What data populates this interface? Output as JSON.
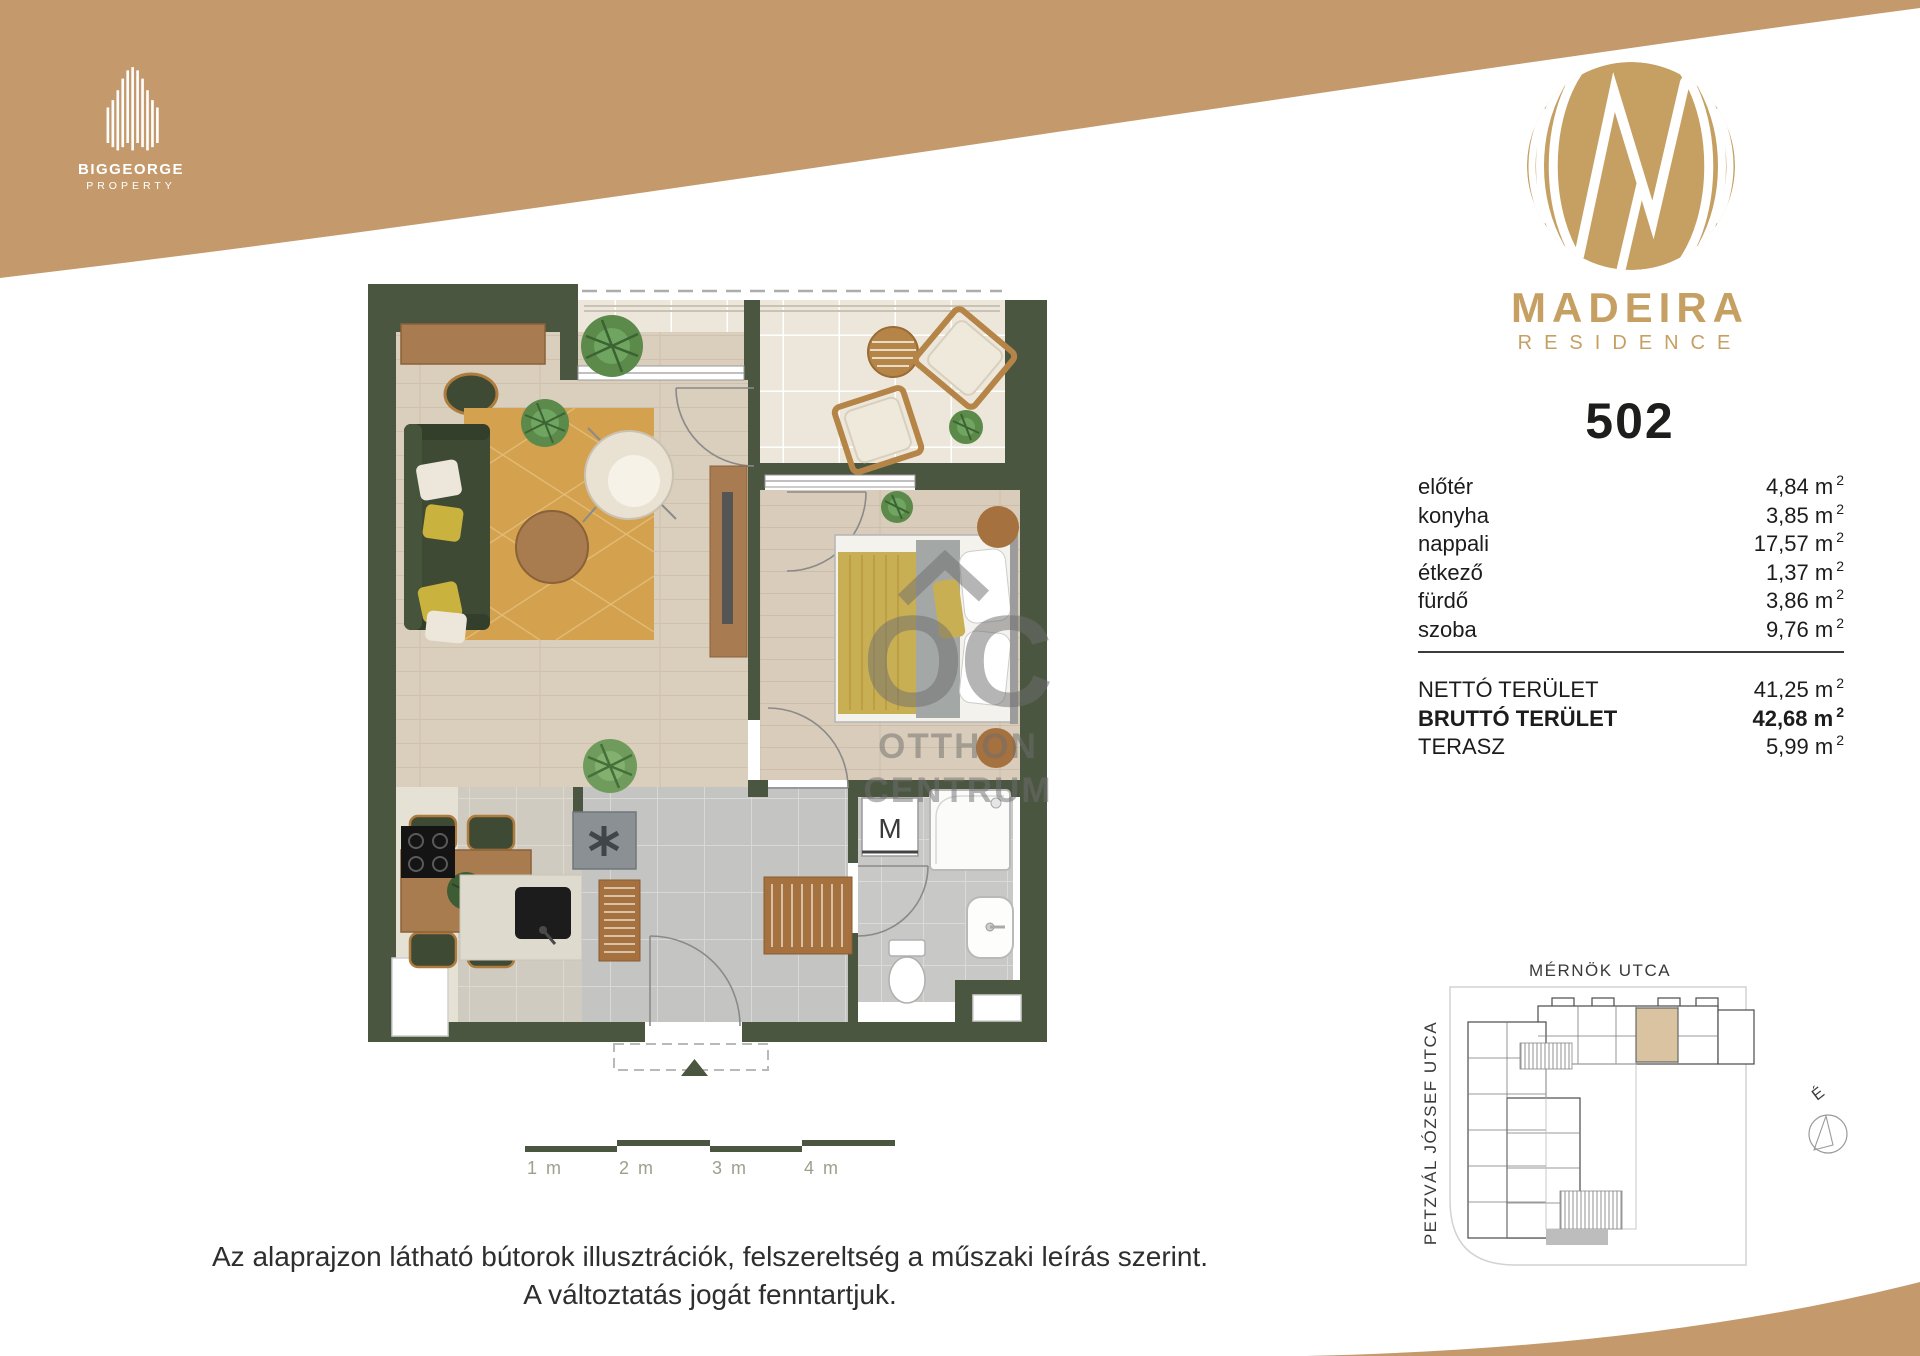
{
  "colors": {
    "gold": "#c49a6c",
    "brand_gold": "#c6a063",
    "wall_green": "#4b5641",
    "text_dark": "#1d1d1b"
  },
  "header": {
    "biggeorge": {
      "name": "BIGGEORGE",
      "sub": "PROPERTY"
    },
    "madeira": {
      "name": "MADEIRA",
      "sub": "RESIDENCE"
    },
    "unit_number": "502"
  },
  "areas": {
    "unit": "m",
    "sup": "2",
    "rooms": [
      {
        "label": "előtér",
        "value": "4,84"
      },
      {
        "label": "konyha",
        "value": "3,85"
      },
      {
        "label": "nappali",
        "value": "17,57"
      },
      {
        "label": "étkező",
        "value": "1,37"
      },
      {
        "label": "fürdő",
        "value": "3,86"
      },
      {
        "label": "szoba",
        "value": "9,76"
      }
    ],
    "totals": [
      {
        "label": "NETTÓ TERÜLET",
        "value": "41,25",
        "bold": false
      },
      {
        "label": "BRUTTÓ TERÜLET",
        "value": "42,68",
        "bold": true
      },
      {
        "label": "TERASZ",
        "value": "5,99",
        "bold": false
      }
    ]
  },
  "floorplan": {
    "washer_label": "M",
    "watermark": {
      "mark": "OC",
      "line1": "OTTHON",
      "line2": "CENTRUM"
    }
  },
  "scalebar": {
    "labels": [
      "1 m",
      "2 m",
      "3 m",
      "4 m"
    ]
  },
  "siteplan": {
    "street_top": "MÉRNÖK UTCA",
    "street_left": "PETZVÁL JÓZSEF UTCA",
    "north_label": "É"
  },
  "disclaimer": {
    "line1": "Az alaprajzon látható bútorok illusztrációk, felszereltség a műszaki leírás szerint.",
    "line2": "A változtatás jogát fenntartjuk."
  }
}
